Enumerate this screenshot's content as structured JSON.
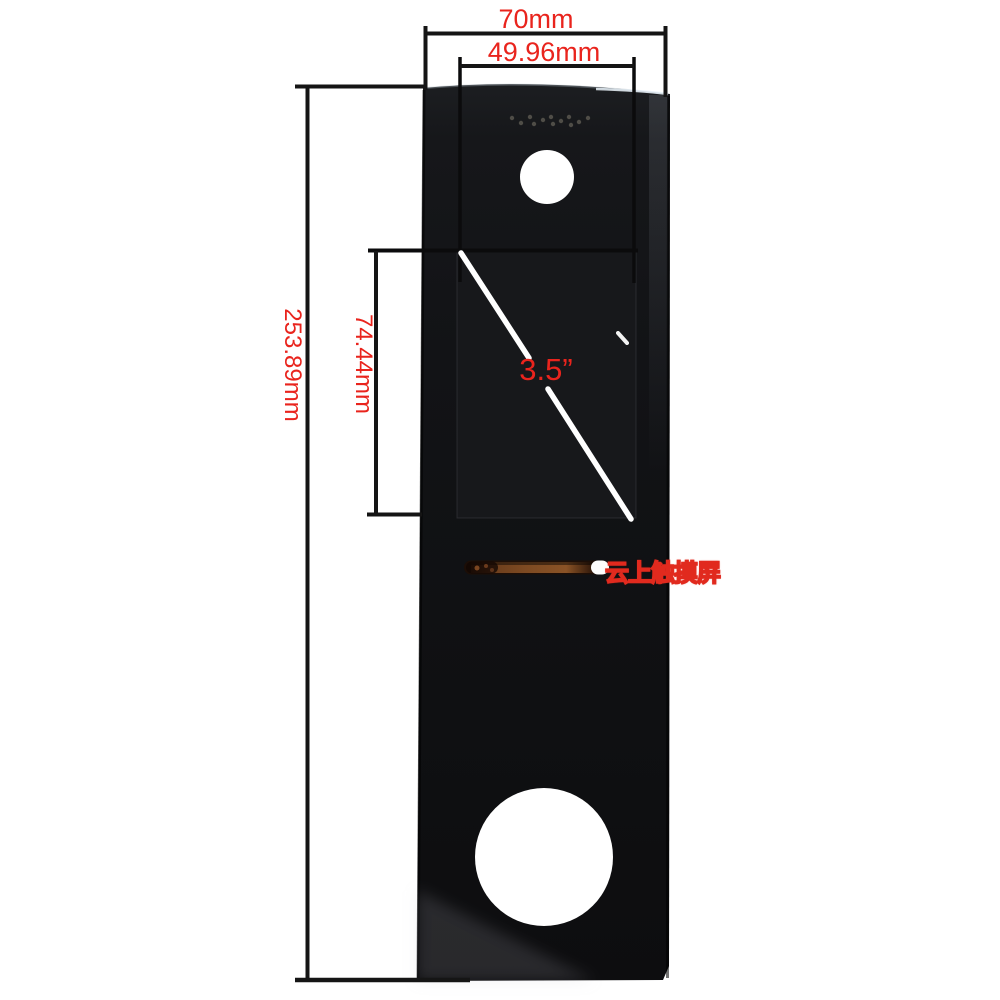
{
  "background_color": "#ffffff",
  "accent_color": "#e9241d",
  "line_color": "#151515",
  "labels": {
    "top_width": "70mm",
    "screen_width": "49.96mm",
    "panel_height": "253.89mm",
    "screen_height": "74.44mm",
    "screen_diagonal": "3.5”"
  },
  "dimensions": {
    "top_width_mm": 70,
    "screen_width_mm": 49.96,
    "panel_height_mm": 253.89,
    "screen_height_mm": 74.44,
    "screen_diagonal_inch": 3.5
  },
  "watermark": {
    "text": "云上触摸屏",
    "color": "#e12a1e"
  },
  "panel": {
    "glass_color": "#121316",
    "screen_color": "#17181b",
    "slot_copper_color": "#7d4a22",
    "speaker_dots": [
      [
        512,
        118
      ],
      [
        521,
        123
      ],
      [
        530,
        117
      ],
      [
        534,
        124
      ],
      [
        543,
        120
      ],
      [
        551,
        117
      ],
      [
        553,
        124
      ],
      [
        561,
        121
      ],
      [
        569,
        117
      ],
      [
        571,
        125
      ],
      [
        579,
        122
      ],
      [
        588,
        118
      ]
    ]
  }
}
